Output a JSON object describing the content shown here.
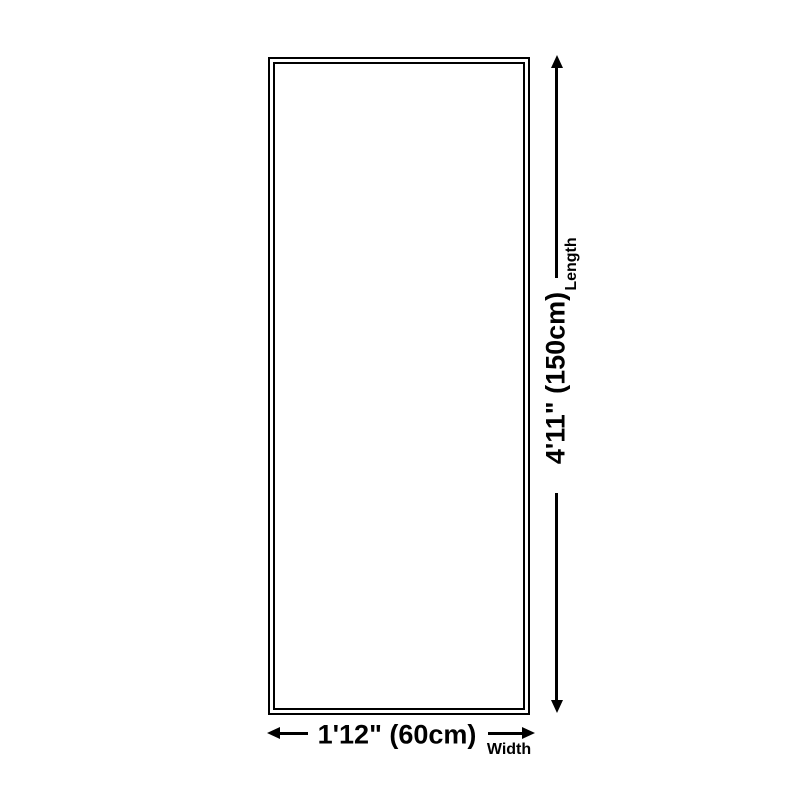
{
  "diagram": {
    "length": {
      "value": "4'11\" (150cm)",
      "label": "Length"
    },
    "width": {
      "value": "1'12\" (60cm)",
      "label": "Width"
    },
    "colors": {
      "line": "#000000",
      "background": "#ffffff"
    }
  }
}
